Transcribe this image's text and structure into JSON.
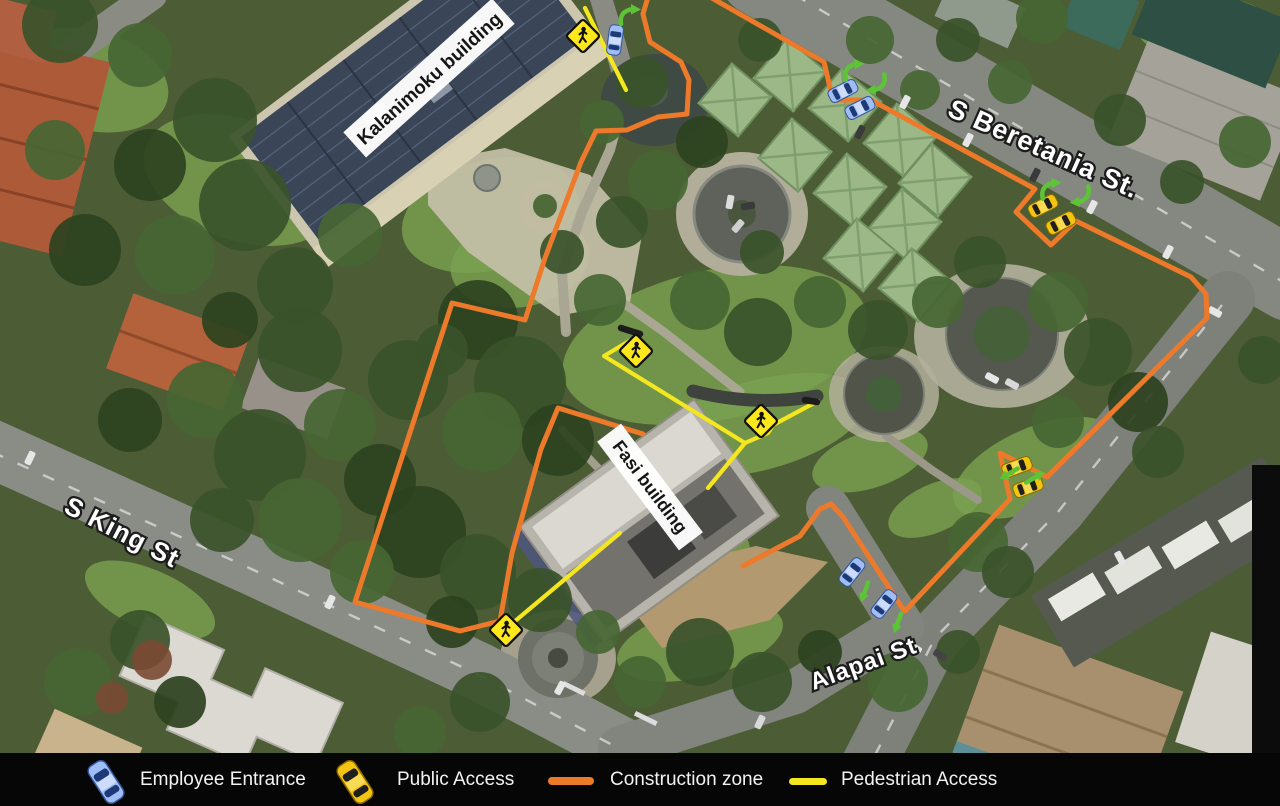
{
  "legend": {
    "items": [
      {
        "label": "Employee Entrance",
        "icon": "blue-car-icon"
      },
      {
        "label": "Public Access",
        "icon": "yellow-car-icon"
      },
      {
        "label": "Construction zone",
        "icon": "orange-line-swatch"
      },
      {
        "label": "Pedestrian Access",
        "icon": "yellow-line-swatch"
      }
    ]
  },
  "map": {
    "street_labels": [
      {
        "text": "S Beretania St."
      },
      {
        "text": "S King St"
      },
      {
        "text": "Alapai St"
      }
    ],
    "building_labels": [
      {
        "text": "Kalanimoku building"
      },
      {
        "text": "Fasi building"
      }
    ],
    "colors": {
      "construction": "#ed7a2b",
      "pedestrian": "#f5e71f",
      "arrow_green": "#5ec437",
      "sign_yellow": "#ffe81c",
      "employee_car": "#9fbef5",
      "public_car": "#f3c512",
      "legend_background": "#060606"
    },
    "construction_zone_paths": [
      [
        [
          648,
          -3
        ],
        [
          643,
          14
        ],
        [
          650,
          42
        ],
        [
          681,
          62
        ],
        [
          689,
          80
        ],
        [
          687,
          114
        ],
        [
          658,
          117
        ],
        [
          627,
          130
        ],
        [
          596,
          131
        ],
        [
          581,
          162
        ],
        [
          545,
          258
        ],
        [
          525,
          320
        ],
        [
          452,
          303
        ],
        [
          355,
          602
        ],
        [
          460,
          631
        ],
        [
          500,
          621
        ],
        [
          512,
          553
        ],
        [
          541,
          449
        ],
        [
          558,
          408
        ],
        [
          643,
          434
        ]
      ],
      [
        [
          710,
          -3
        ],
        [
          824,
          62
        ],
        [
          833,
          100
        ],
        [
          871,
          100
        ],
        [
          1035,
          189
        ],
        [
          1016,
          212
        ],
        [
          1051,
          245
        ],
        [
          1076,
          221
        ],
        [
          1191,
          277
        ],
        [
          1206,
          294
        ],
        [
          1207,
          318
        ],
        [
          1047,
          477
        ],
        [
          1000,
          453
        ],
        [
          1010,
          499
        ],
        [
          905,
          611
        ]
      ],
      [
        [
          743,
          566
        ],
        [
          800,
          536
        ],
        [
          820,
          509
        ],
        [
          831,
          504
        ],
        [
          843,
          517
        ],
        [
          903,
          609
        ]
      ]
    ],
    "pedestrian_paths": [
      [
        [
          585,
          8
        ],
        [
          626,
          90
        ]
      ],
      [
        [
          641,
          334
        ],
        [
          604,
          356
        ],
        [
          745,
          443
        ],
        [
          708,
          488
        ]
      ],
      [
        [
          818,
          401
        ],
        [
          773,
          425
        ],
        [
          768,
          433
        ],
        [
          745,
          443
        ]
      ],
      [
        [
          620,
          533
        ],
        [
          508,
          627
        ]
      ]
    ],
    "path_end_caps": [
      [
        [
          621,
          328
        ],
        [
          640,
          334
        ]
      ],
      [
        [
          805,
          400
        ],
        [
          817,
          402
        ]
      ]
    ],
    "crossing_signs": [
      {
        "x": 583,
        "y": 36
      },
      {
        "x": 636,
        "y": 351
      },
      {
        "x": 761,
        "y": 421
      },
      {
        "x": 506,
        "y": 630
      }
    ],
    "employee_cars": [
      {
        "x": 615,
        "y": 40,
        "rotate": 8
      },
      {
        "x": 843,
        "y": 91,
        "rotate": 63
      },
      {
        "x": 860,
        "y": 108,
        "rotate": 63
      },
      {
        "x": 852,
        "y": 572,
        "rotate": 38
      },
      {
        "x": 884,
        "y": 604,
        "rotate": 38
      }
    ],
    "public_cars": [
      {
        "x": 1043,
        "y": 206,
        "rotate": 63
      },
      {
        "x": 1061,
        "y": 223,
        "rotate": 63
      },
      {
        "x": 1017,
        "y": 467,
        "rotate": 70
      },
      {
        "x": 1028,
        "y": 487,
        "rotate": 70
      }
    ],
    "turn_arrows": [
      {
        "x": 629,
        "y": 15,
        "rotate": 0
      },
      {
        "x": 853,
        "y": 70,
        "rotate": -5
      },
      {
        "x": 877,
        "y": 84,
        "rotate": 175
      },
      {
        "x": 1050,
        "y": 189,
        "rotate": -5
      },
      {
        "x": 1081,
        "y": 196,
        "rotate": 175
      }
    ],
    "direction_arrows": [
      {
        "x": 1010,
        "y": 473,
        "rotate": 240
      },
      {
        "x": 1034,
        "y": 478,
        "rotate": 60
      },
      {
        "x": 865,
        "y": 591,
        "rotate": 200
      },
      {
        "x": 898,
        "y": 622,
        "rotate": 200
      }
    ]
  }
}
